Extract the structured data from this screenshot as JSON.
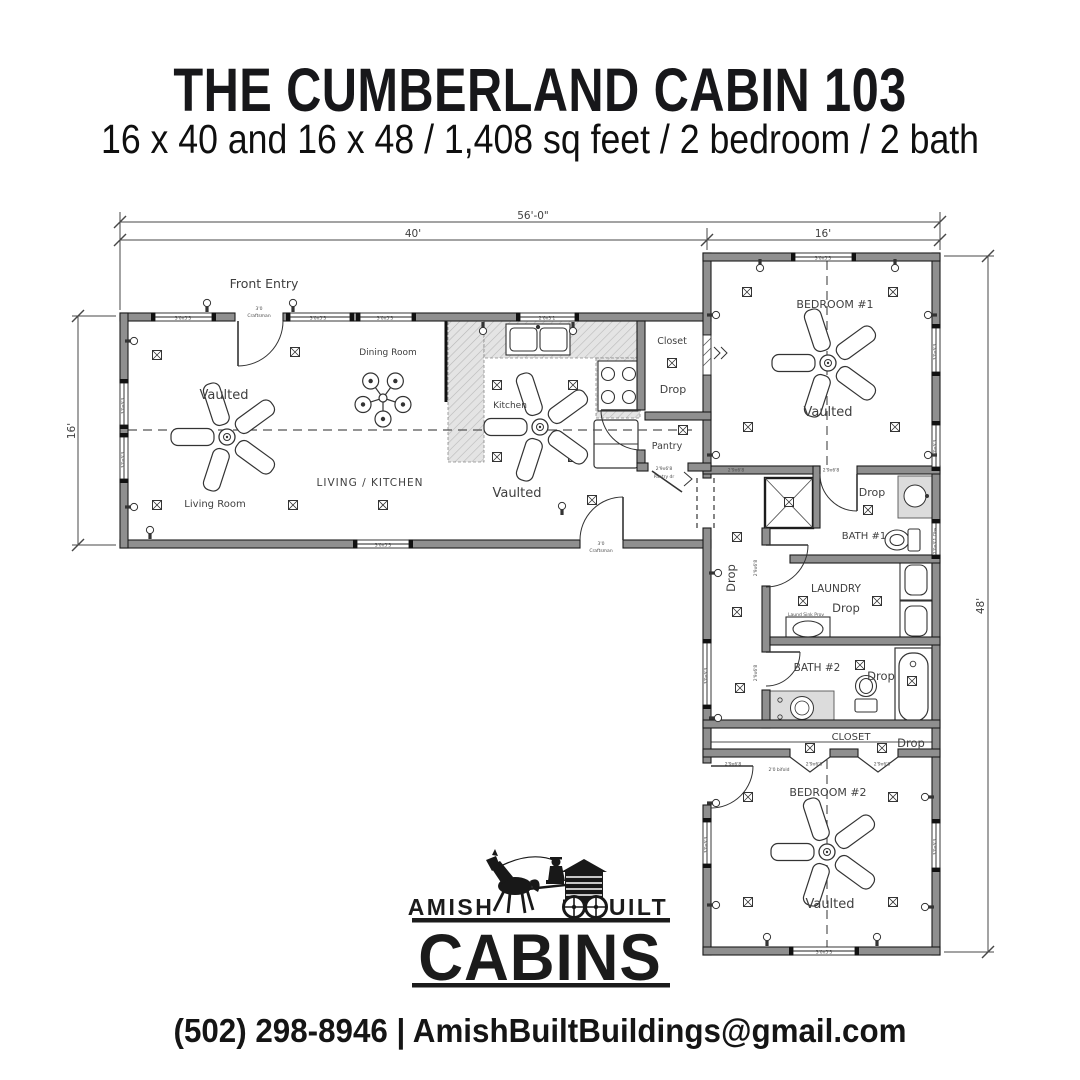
{
  "colors": {
    "ink": "#1a1a1d",
    "wall_fill": "#8f8f8f",
    "wall_stroke": "#1c1c1c",
    "line": "#3a3a3a",
    "label": "#3f3f3f",
    "tiny": "#4c4c4c",
    "counter": "#e4e4e4",
    "vanity": "#dcdcdc"
  },
  "header": {
    "title": "THE CUMBERLAND CABIN 103",
    "subtitle": "16 x 40 and 16 x 48 / 1,408 sq feet / 2 bedroom / 2 bath"
  },
  "footer": {
    "contact": "(502) 298-8946 | AmishBuiltBuildings@gmail.com"
  },
  "logo": {
    "left": "AMISH",
    "right": "BUILT",
    "main": "CABINS",
    "icon": "horse-drawn-log-cabin-wagon-icon"
  },
  "plan": {
    "dimensions": {
      "overall_width": "56'-0\"",
      "left_module_width": "40'",
      "right_module_width": "16'",
      "left_module_depth": "16'",
      "right_module_depth": "48'"
    },
    "labels": [
      {
        "t": "Front Entry",
        "x": 264,
        "y": 288,
        "s": 12.5
      },
      {
        "t": "Dining Room",
        "x": 388,
        "y": 355,
        "s": 9
      },
      {
        "t": "Vaulted",
        "x": 224,
        "y": 399,
        "s": 13
      },
      {
        "t": "Living Room",
        "x": 215,
        "y": 507,
        "s": 10
      },
      {
        "t": "LIVING / KITCHEN",
        "x": 370,
        "y": 486,
        "s": 10.5,
        "ls": 1
      },
      {
        "t": "Kitchen",
        "x": 510,
        "y": 408,
        "s": 9
      },
      {
        "t": "Vaulted",
        "x": 517,
        "y": 497,
        "s": 13
      },
      {
        "t": "Closet",
        "x": 672,
        "y": 344,
        "s": 9.5
      },
      {
        "t": "Drop",
        "x": 673,
        "y": 393,
        "s": 11
      },
      {
        "t": "Pantry",
        "x": 667,
        "y": 449,
        "s": 9.5
      },
      {
        "t": "BEDROOM #1",
        "x": 835,
        "y": 308,
        "s": 11
      },
      {
        "t": "Vaulted",
        "x": 828,
        "y": 416,
        "s": 13
      },
      {
        "t": "Drop",
        "x": 872,
        "y": 496,
        "s": 11
      },
      {
        "t": "BATH #1",
        "x": 864,
        "y": 539,
        "s": 10
      },
      {
        "t": "LAUNDRY",
        "x": 836,
        "y": 592,
        "s": 10.5
      },
      {
        "t": "Drop",
        "x": 846,
        "y": 612,
        "s": 11.5
      },
      {
        "t": "Drop",
        "x": 735,
        "y": 578,
        "s": 11.5,
        "r": -90
      },
      {
        "t": "BATH #2",
        "x": 817,
        "y": 671,
        "s": 10.5
      },
      {
        "t": "Drop",
        "x": 881,
        "y": 680,
        "s": 11.5
      },
      {
        "t": "CLOSET",
        "x": 851,
        "y": 740,
        "s": 10
      },
      {
        "t": "Drop",
        "x": 911,
        "y": 747,
        "s": 11.5
      },
      {
        "t": "BEDROOM #2",
        "x": 828,
        "y": 796,
        "s": 11
      },
      {
        "t": "Vaulted",
        "x": 830,
        "y": 908,
        "s": 13
      },
      {
        "t": "56'-0\"",
        "x": 533,
        "y": 219,
        "s": 10.5,
        "halo": true
      },
      {
        "t": "40'",
        "x": 413,
        "y": 237,
        "s": 10.5,
        "halo": true
      },
      {
        "t": "16'",
        "x": 823,
        "y": 237,
        "s": 10.5,
        "halo": true
      },
      {
        "t": "16'",
        "x": 75,
        "y": 431,
        "s": 10.5,
        "r": -90,
        "halo": true
      },
      {
        "t": "48'",
        "x": 984,
        "y": 606,
        "s": 10.5,
        "r": -90,
        "halo": true
      }
    ],
    "tiny_labels": [
      {
        "t": "3'0x5'3",
        "x": 183,
        "y": 319.5
      },
      {
        "t": "3'0x5'3",
        "x": 318,
        "y": 319.5
      },
      {
        "t": "3'0x5'3",
        "x": 385,
        "y": 319.5
      },
      {
        "t": "2'6x3'1",
        "x": 547,
        "y": 319.5
      },
      {
        "t": "3'0x5'3",
        "x": 383,
        "y": 546.5
      },
      {
        "t": "3'0x5'3",
        "x": 823,
        "y": 259.5
      },
      {
        "t": "3'0x5'3",
        "x": 824,
        "y": 953.5
      },
      {
        "t": "3'0x5'3",
        "x": 124.5,
        "y": 406,
        "r": -90
      },
      {
        "t": "3'0x5'3",
        "x": 124.5,
        "y": 460,
        "r": -90
      },
      {
        "t": "3'0x5'3",
        "x": 936.5,
        "y": 352,
        "r": -90
      },
      {
        "t": "3'0x5'3",
        "x": 936.5,
        "y": 448,
        "r": -90
      },
      {
        "t": "2'0x3'1 Obs",
        "x": 936.5,
        "y": 541,
        "r": -90
      },
      {
        "t": "3'0x5'3",
        "x": 936.5,
        "y": 847,
        "r": -90
      },
      {
        "t": "3'0x5'3",
        "x": 707.5,
        "y": 676,
        "r": -90
      },
      {
        "t": "3'0x5'3",
        "x": 707.5,
        "y": 845,
        "r": -90
      },
      {
        "t": "2'9x6'8",
        "x": 736,
        "y": 471.5
      },
      {
        "t": "2'9x6'8",
        "x": 831,
        "y": 471.5
      },
      {
        "t": "2'9x6'8",
        "x": 664,
        "y": 470
      },
      {
        "t": "Pantry dr",
        "x": 664,
        "y": 478
      },
      {
        "t": "2'9x6'8",
        "x": 733,
        "y": 765.5
      },
      {
        "t": "2'9x6'8",
        "x": 814,
        "y": 765.5
      },
      {
        "t": "2'9x6'8",
        "x": 882,
        "y": 765.5
      },
      {
        "t": "2'0 bifold",
        "x": 779,
        "y": 771
      },
      {
        "t": "2'9x6'8",
        "x": 757,
        "y": 568,
        "r": -90
      },
      {
        "t": "2'9x6'8",
        "x": 757,
        "y": 673,
        "r": -90
      },
      {
        "t": "3'0",
        "x": 259,
        "y": 310
      },
      {
        "t": "Craftsman",
        "x": 259,
        "y": 317
      },
      {
        "t": "3'0",
        "x": 601,
        "y": 545
      },
      {
        "t": "Craftsman",
        "x": 601,
        "y": 552
      },
      {
        "t": "Laund Sink Prov",
        "x": 806,
        "y": 616
      }
    ],
    "ceiling_fans": [
      {
        "x": 227,
        "y": 437,
        "type": "large"
      },
      {
        "x": 540,
        "y": 427,
        "type": "large"
      },
      {
        "x": 828,
        "y": 363,
        "type": "large"
      },
      {
        "x": 827,
        "y": 852,
        "type": "large"
      },
      {
        "x": 383,
        "y": 398,
        "type": "dining-light"
      }
    ],
    "junction_boxes": [
      [
        157,
        355
      ],
      [
        295,
        352
      ],
      [
        157,
        505
      ],
      [
        293,
        505
      ],
      [
        383,
        505
      ],
      [
        592,
        500
      ],
      [
        497,
        385
      ],
      [
        573,
        385
      ],
      [
        497,
        457
      ],
      [
        573,
        457
      ],
      [
        672,
        363
      ],
      [
        683,
        430
      ],
      [
        789,
        502
      ],
      [
        747,
        292
      ],
      [
        893,
        292
      ],
      [
        748,
        427
      ],
      [
        895,
        427
      ],
      [
        868,
        510
      ],
      [
        737,
        537
      ],
      [
        803,
        601
      ],
      [
        877,
        601
      ],
      [
        737,
        612
      ],
      [
        860,
        665
      ],
      [
        912,
        681
      ],
      [
        740,
        688
      ],
      [
        810,
        748
      ],
      [
        882,
        748
      ],
      [
        748,
        797
      ],
      [
        893,
        797
      ],
      [
        748,
        902
      ],
      [
        893,
        902
      ]
    ],
    "wall_lights": [
      [
        207,
        303,
        "d"
      ],
      [
        293,
        303,
        "d"
      ],
      [
        483,
        331,
        "u"
      ],
      [
        573,
        331,
        "u"
      ],
      [
        760,
        268,
        "u"
      ],
      [
        895,
        268,
        "u"
      ],
      [
        134,
        341,
        "l"
      ],
      [
        134,
        507,
        "l"
      ],
      [
        150,
        530,
        "d"
      ],
      [
        562,
        506,
        "d"
      ],
      [
        767,
        937,
        "d"
      ],
      [
        877,
        937,
        "d"
      ],
      [
        716,
        315,
        "l"
      ],
      [
        928,
        315,
        "r"
      ],
      [
        716,
        455,
        "l"
      ],
      [
        928,
        455,
        "r"
      ],
      [
        718,
        573,
        "l"
      ],
      [
        718,
        718,
        "l"
      ],
      [
        716,
        803,
        "l"
      ],
      [
        925,
        797,
        "r"
      ],
      [
        716,
        905,
        "l"
      ],
      [
        925,
        907,
        "r"
      ]
    ],
    "windows": {
      "horizontal": [
        [
          313,
          155,
          212
        ],
        [
          313,
          290,
          350
        ],
        [
          313,
          360,
          412
        ],
        [
          313,
          520,
          575
        ],
        [
          540,
          357,
          409
        ],
        [
          253,
          795,
          852
        ],
        [
          947,
          793,
          855
        ]
      ],
      "vertical": [
        [
          120,
          383,
          425
        ],
        [
          120,
          437,
          479
        ],
        [
          703,
          643,
          705
        ],
        [
          703,
          822,
          864
        ],
        [
          932,
          328,
          372
        ],
        [
          932,
          425,
          467
        ],
        [
          932,
          523,
          555
        ],
        [
          932,
          823,
          868
        ]
      ]
    }
  }
}
